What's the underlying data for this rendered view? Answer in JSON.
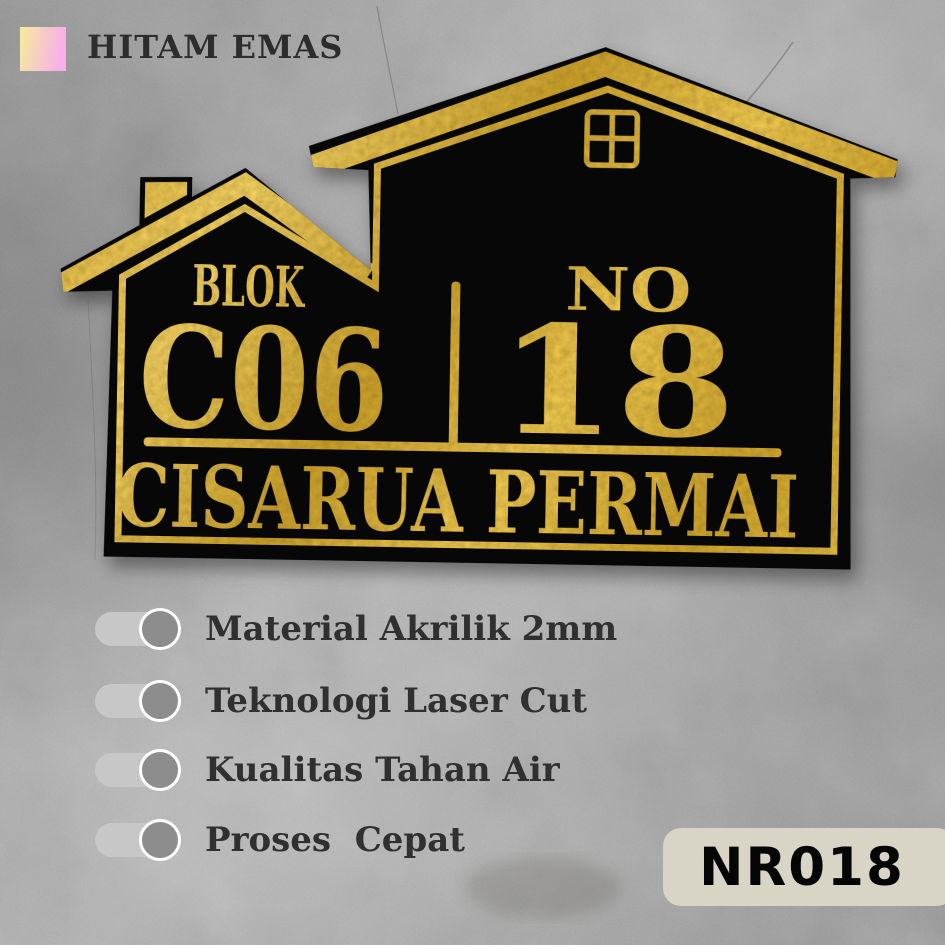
{
  "variant": {
    "label": "HITAM EMAS",
    "swatch_gradient": [
      "#f6e8a0",
      "#f8b0e8"
    ]
  },
  "sign": {
    "blok_label": "BLOK",
    "blok_value": "C06",
    "no_label": "NO",
    "no_value": "18",
    "street_name": "CISARUA PERMAI",
    "colors": {
      "acrylic_black": "#070707",
      "gold": "#e7bd3e"
    }
  },
  "features": [
    {
      "label": "Material Akrilik 2mm"
    },
    {
      "label": "Teknologi Laser Cut"
    },
    {
      "label": "Kualitas Tahan Air"
    },
    {
      "label": "Proses  Cepat"
    }
  ],
  "product_code": {
    "text": "NR018",
    "bg": "#d8d4c6"
  },
  "toggle_colors": {
    "pill": "#c7c7c7",
    "knob": "#8d8d8d",
    "ring": "#ffffff"
  }
}
